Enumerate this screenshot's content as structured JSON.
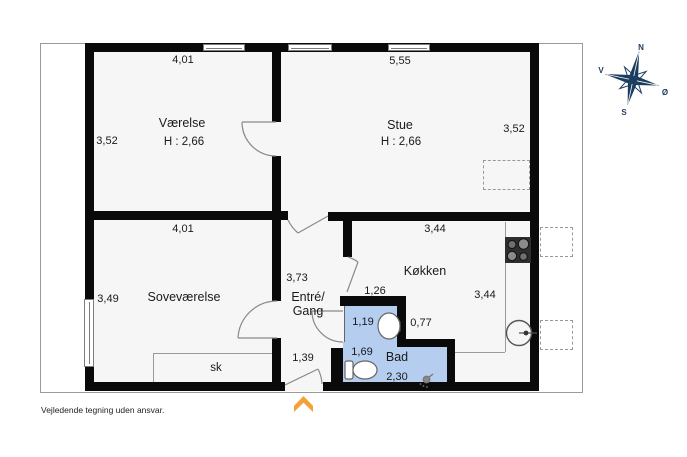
{
  "title": "floor-plan",
  "frame_note": "Vejledende tegning uden ansvar.",
  "compass": {
    "north": "N",
    "south": "S",
    "east": "Ø",
    "west": "V"
  },
  "rooms": {
    "vaerelse": {
      "name": "Værelse",
      "ceiling": "H : 2,66",
      "width_top": "4,01",
      "height_left": "3,52"
    },
    "stue": {
      "name": "Stue",
      "ceiling": "H : 2,66",
      "width_top": "5,55",
      "height_right": "3,52"
    },
    "sovevaerelse": {
      "name": "Soveværelse",
      "width_top": "4,01",
      "height_left": "3,49",
      "closet": "sk"
    },
    "entre": {
      "name_line1": "Entré/",
      "name_line2": "Gang",
      "length": "3,73",
      "entrance_width": "1,39"
    },
    "koekken": {
      "name": "Køkken",
      "width_top": "3,44",
      "height_right": "3,44",
      "width_left": "1,26"
    },
    "bad": {
      "name": "Bad",
      "width_top": "1,19",
      "step_width": "0,77",
      "height_left": "1,69",
      "width_bottom": "2,30"
    }
  },
  "colors": {
    "wall": "#0a0a0a",
    "room_fill": "#f6f6f6",
    "bathroom_fill": "#b5cdef",
    "entrance_arrow": "#f2a237",
    "compass": "#1c3d5f"
  },
  "icons": [
    "compass-rose-icon",
    "stove-icon",
    "kitchen-sink-icon",
    "bathroom-sink-icon",
    "toilet-icon",
    "shower-icon",
    "entrance-arrow-icon"
  ]
}
